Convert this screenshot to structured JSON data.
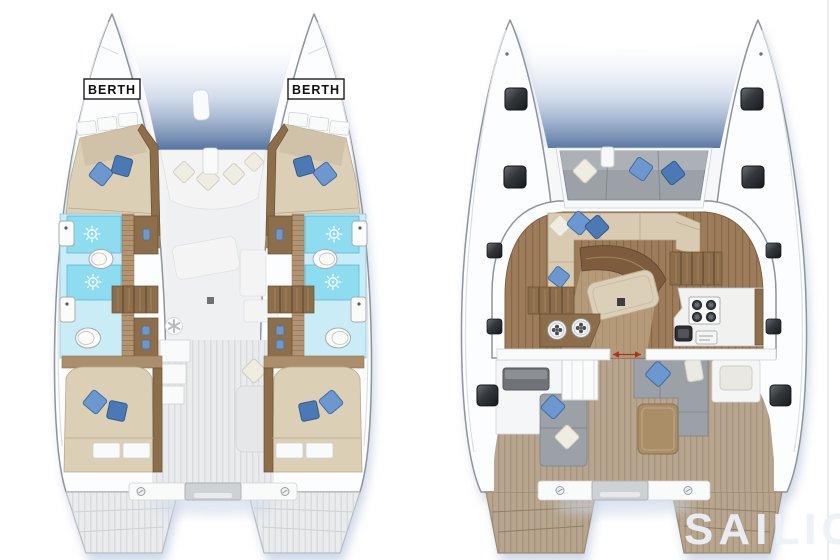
{
  "plans": {
    "lower_deck": {
      "berth_labels": [
        "BERTH",
        "BERTH"
      ],
      "icons": [
        "shower-sun-icon",
        "toilet-icon",
        "sink-icon",
        "wardrobe-handle-icon",
        "ceiling-fan-icon",
        "bolt-icon",
        "pillow-icon",
        "stairs-icon"
      ]
    },
    "main_deck": {
      "icons": [
        "deck-hatch-icon",
        "stove-burner-icon",
        "round-sink-icon",
        "companionway-stairs-icon",
        "sliding-door-arrows-icon",
        "bolt-icon",
        "pillow-icon"
      ]
    }
  },
  "watermark": {
    "text": "SAILICA"
  },
  "palette": {
    "hull_white": "#fcfdfe",
    "outline_gray": "#8d949c",
    "shadow_blue": "#c3cfe2",
    "bed_beige": "#dbcfb6",
    "wood_brown": "#8d6e4b",
    "pillow_blue": "#6d98cf",
    "pillow_blue_dark": "#4a79b6",
    "shower_blue": "#8edcf0",
    "tile_blue": "#c9ecf6",
    "saloon_floor": "#9c7c59",
    "deck_tan": "#b7a58e",
    "deck_gray": "#e9ebec",
    "seat_gray": "#9ba1a6",
    "sofa_beige": "#d8cbb1",
    "hatch_dark": "#17191c",
    "arrow_red": "#b03020"
  }
}
